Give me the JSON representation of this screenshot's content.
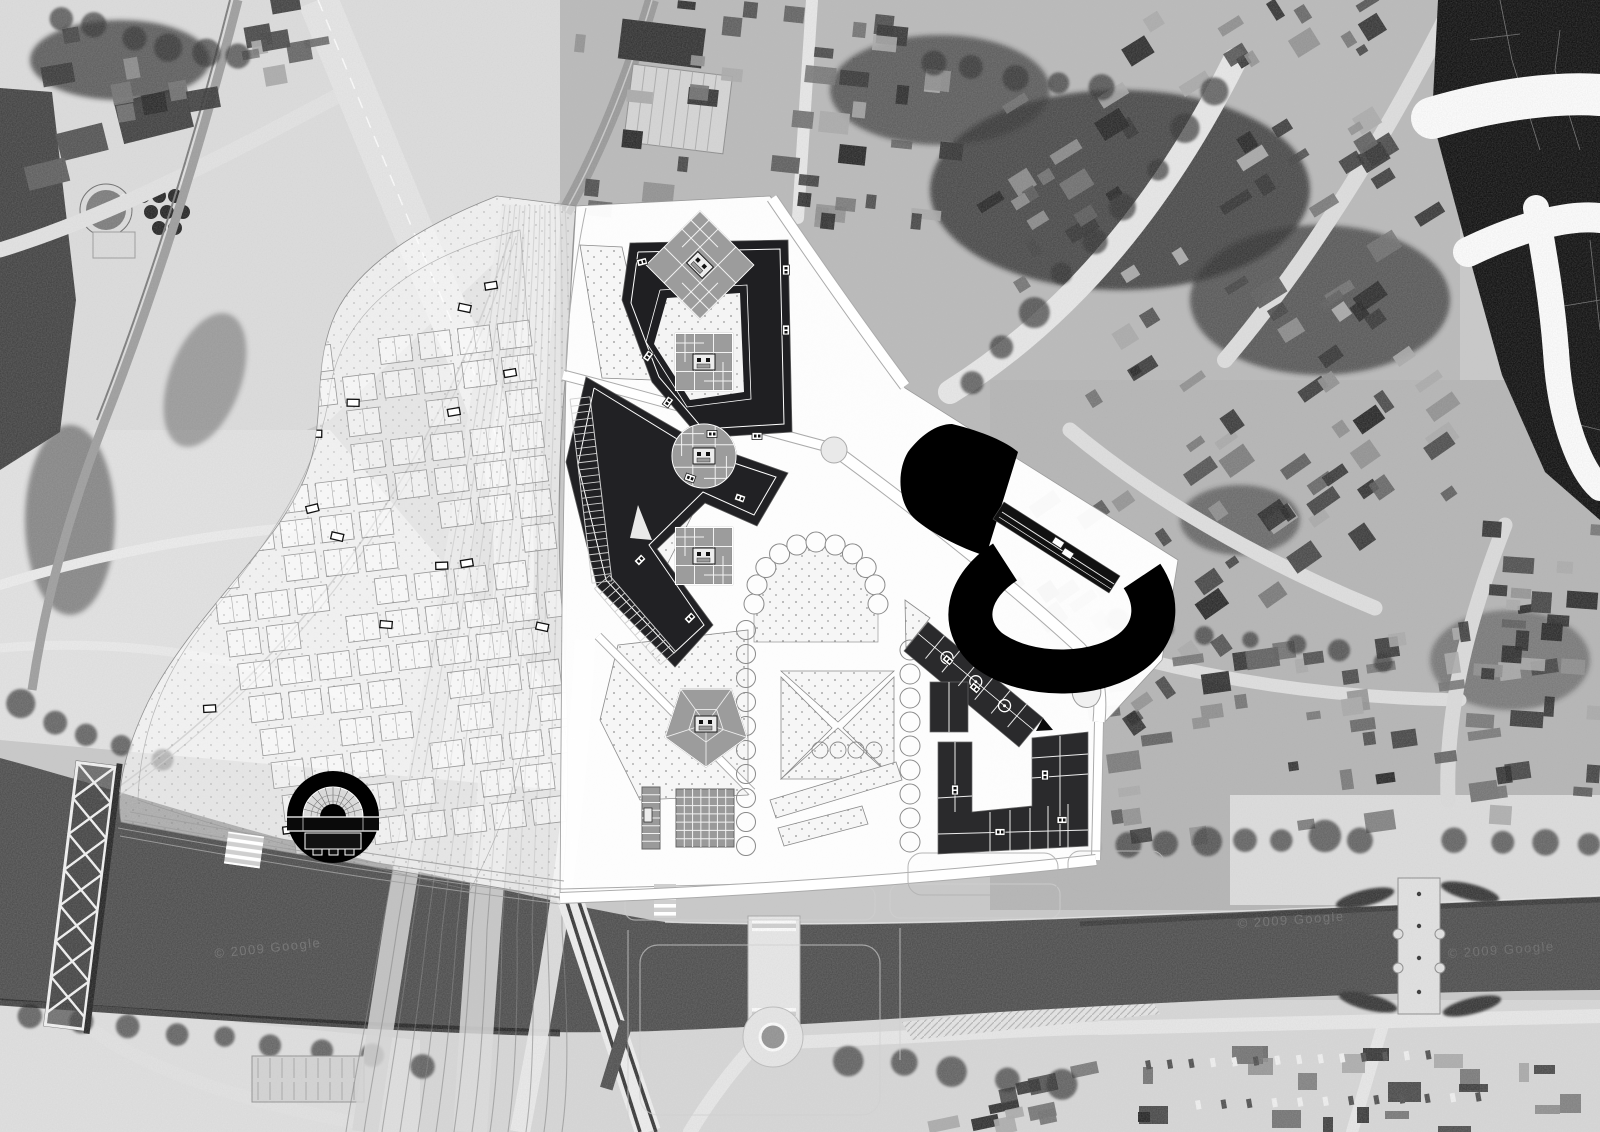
{
  "image": {
    "kind": "urban masterplan photomontage",
    "view": "aerial top-down",
    "style": "black and white site plan over aerial photograph"
  },
  "watermarks": [
    {
      "text": "© 2009 Google"
    },
    {
      "text": "© 2009 Google"
    },
    {
      "text": "© 2009 Google"
    }
  ],
  "palette": {
    "photo_base": "#c9c9c9",
    "photo_light": "#e2e2e2",
    "photo_dark_mass": "#2e2e2e",
    "river": "#474747",
    "figure_ground_black": "#060606",
    "plan_white": "#ffffff",
    "plan_building_dark": "#1f1f22",
    "plan_building_black": "#000000",
    "tower_grey": "#9c9c9c",
    "plan_line_grey": "#8a8a8a",
    "tree_outline": "#8a8a8a",
    "watermark": "#f0f0f0"
  },
  "features": [
    "aerial-photo-backdrop",
    "river-canal",
    "railway-fan-landscape",
    "masterplan-overlay",
    "north-courtyard-block",
    "chevron-block",
    "tower-footprints",
    "pentagon-pavilion",
    "market-grid",
    "park-parcels",
    "tree-arc",
    "row-housing-bar",
    "row-housing-u",
    "black-blob-building",
    "black-c-building",
    "tram-platform",
    "roundhouse-theatre",
    "truss-bridge",
    "road-bridge",
    "ornate-bridge",
    "roundabout",
    "figure-ground-corner"
  ]
}
